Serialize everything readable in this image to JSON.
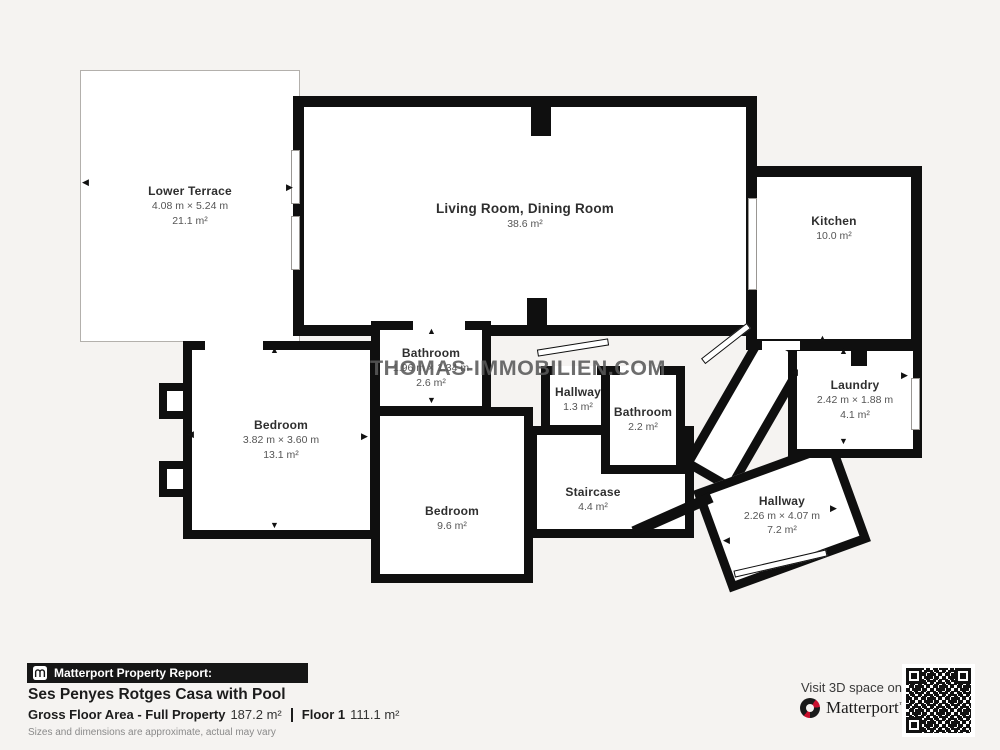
{
  "watermark": "THOMAS-IMMOBILIEN.COM",
  "icons": {
    "arrow_up": "▲",
    "arrow_down": "▼",
    "arrow_left": "◀",
    "arrow_right": "▶"
  },
  "rooms": {
    "lower_terrace": {
      "name": "Lower Terrace",
      "dimensions": "4.08 m × 5.24 m",
      "area": "21.1 m²"
    },
    "living_dining": {
      "name": "Living Room, Dining Room",
      "area": "38.6 m²"
    },
    "kitchen": {
      "name": "Kitchen",
      "area": "10.0 m²"
    },
    "laundry": {
      "name": "Laundry",
      "dimensions": "2.42 m × 1.88 m",
      "area": "4.1 m²"
    },
    "bedroom_left": {
      "name": "Bedroom",
      "dimensions": "3.82 m × 3.60 m",
      "area": "13.1 m²"
    },
    "bathroom_top": {
      "name": "Bathroom",
      "dimensions": "1.96 m × 1.34 m",
      "area": "2.6 m²"
    },
    "hallway_small": {
      "name": "Hallway",
      "area": "1.3 m²"
    },
    "bathroom_small": {
      "name": "Bathroom",
      "area": "2.2 m²"
    },
    "bedroom_mid": {
      "name": "Bedroom",
      "area": "9.6 m²"
    },
    "staircase": {
      "name": "Staircase",
      "area": "4.4 m²"
    },
    "hallway_right": {
      "name": "Hallway",
      "dimensions": "2.26 m × 4.07 m",
      "area": "7.2 m²"
    }
  },
  "footer": {
    "report_label": "Matterport Property Report:",
    "property_title": "Ses Penyes Rotges Casa with Pool",
    "gross_label": "Gross Floor Area - Full Property",
    "gross_value": "187.2 m²",
    "floor_label": "Floor 1",
    "floor_value": "111.1 m²",
    "disclaimer": "Sizes and dimensions are approximate, actual may vary"
  },
  "cta": {
    "visit_text": "Visit 3D space on",
    "brand": "Matterport",
    "tm": "™"
  },
  "colors": {
    "background": "#f5f3f1",
    "wall": "#0f0f0f",
    "room_fill": "#ffffff",
    "watermark_gray": "#595959",
    "matterport_red": "#c8102e"
  }
}
